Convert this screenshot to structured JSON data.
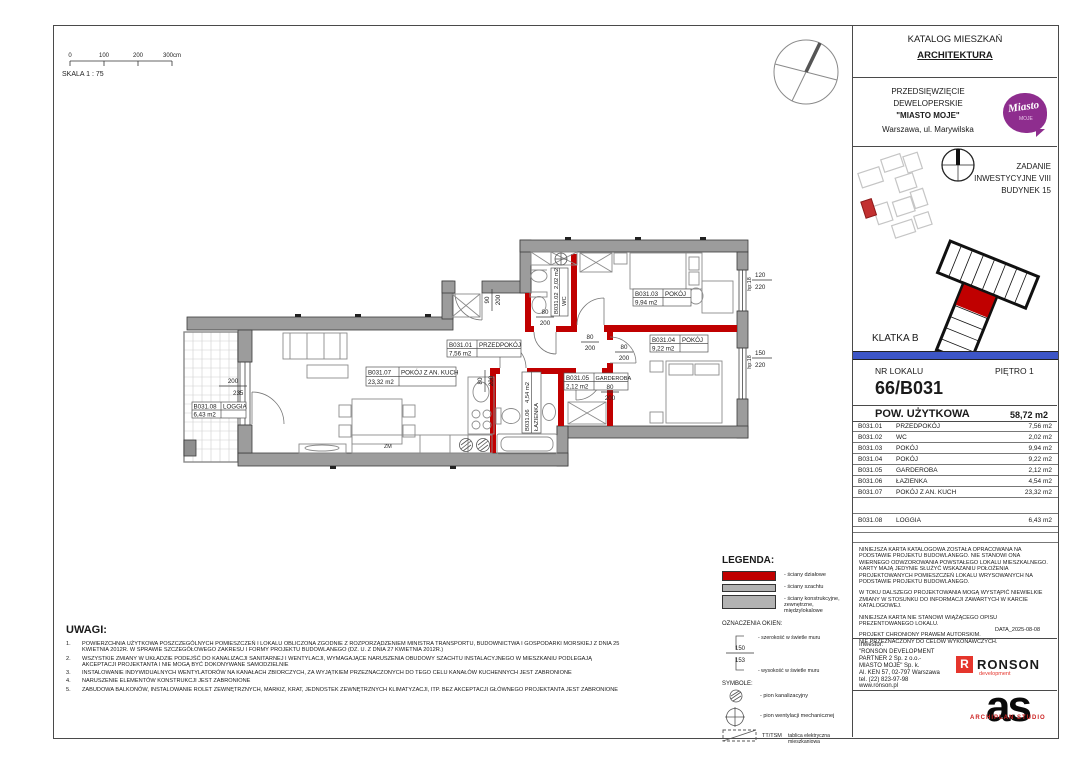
{
  "sheet": {
    "scale": {
      "t0": "0",
      "t1": "100",
      "t2": "200",
      "t3": "300cm",
      "label": "SKALA 1 : 75"
    }
  },
  "title_block": {
    "catalog_line1": "KATALOG MIESZKAŃ",
    "catalog_line2": "ARCHITEKTURA",
    "development": {
      "line1": "PRZEDSIĘWZIĘCIE",
      "line2": "DEWELOPERSKIE",
      "line3": "\"MIASTO MOJE\"",
      "line4": "Warszawa, ul. Marywilska"
    },
    "logo": {
      "line1": "Miasto",
      "line2": "MOJE",
      "color": "#8e2d8e"
    },
    "task": {
      "line1": "ZADANIE",
      "line2": "INWESTYCYJNE VIII",
      "line3": "BUDYNEK 15"
    },
    "staircase": "KLATKA  B",
    "unit": {
      "label": "NR LOKALU",
      "floor": "PIĘTRO 1",
      "number": "66/B031"
    },
    "area_header": {
      "label": "POW. UŻYTKOWA",
      "value": "58,72 m2"
    },
    "rooms": [
      {
        "id": "B031.01",
        "name": "PRZEDPOKÓJ",
        "area": "7,56 m2"
      },
      {
        "id": "B031.02",
        "name": "WC",
        "area": "2,02 m2"
      },
      {
        "id": "B031.03",
        "name": "POKÓJ",
        "area": "9,94 m2"
      },
      {
        "id": "B031.04",
        "name": "POKÓJ",
        "area": "9,22 m2"
      },
      {
        "id": "B031.05",
        "name": "GARDEROBA",
        "area": "2,12 m2"
      },
      {
        "id": "B031.06",
        "name": "ŁAZIENKA",
        "area": "4,54 m2"
      },
      {
        "id": "B031.07",
        "name": "POKÓJ Z AN. KUCH",
        "area": "23,32 m2"
      },
      {
        "id": "B031.08",
        "name": "LOGGIA",
        "area": "6,43 m2"
      }
    ],
    "disclaimer": {
      "p1": "NINIEJSZA KARTA KATALOGOWA ZOSTAŁA OPRACOWANA NA PODSTAWIE PROJEKTU BUDOWLANEGO. NIE STANOWI ONA WIERNEGO ODWZOROWANIA POWSTAŁEGO LOKALU MIESZKALNEGO. KARTY MAJĄ JEDYNIE SŁUŻYĆ WSKAZANIU POŁOŻENIA PROJEKTOWANYCH POMIESZCZEŃ LOKALU WRYSOWANYCH NA PODSTAWIE PROJEKTU BUDOWLANEGO.",
      "p2": "W TOKU DALSZEGO PROJEKTOWANIA MOGĄ WYSTĄPIĆ NIEWIELKIE ZMIANY W STOSUNKU DO INFORMACJI ZAWARTYCH W KARCIE KATALOGOWEJ.",
      "p3": "NINIEJSZA KARTA NIE STANOWI WIĄŻĄCEGO OPISU PREZENTOWANEGO LOKALU.",
      "c1": "PROJEKT CHRONIONY PRAWEM AUTORSKIM.",
      "c2": "NIE PRZEZNACZONY DO CELÓW WYKONAWCZYCH.",
      "date": "DATA_2025-08-08"
    },
    "investor": {
      "label": "Inwestor:",
      "l1": "\"RONSON DEVELOPMENT",
      "l2": "PARTNER 2 Sp. z o.o.-",
      "l3": "MIASTO MOJE\" Sp. k.",
      "l4": "Al. KEN 57, 02-797 Warszawa",
      "l5": "tel. (22) 823-97-98",
      "l6": "www.ronson.pl",
      "brand_letter": "R",
      "brand": "RONSON",
      "brand_sub": "development",
      "brand_red": "#e5352c"
    },
    "studio": {
      "mark": "as",
      "caption": "ARCHIPLAN STUDIO"
    }
  },
  "legend": {
    "title": "LEGENDA:",
    "item1": "- ściany działowe",
    "item2": "- ściany szachtu",
    "item3": "- ściany konstrukcyjne, zewnętrzne, międzylokalowe",
    "windows_title": "OZNACZENIA OKIEN:",
    "win_w": "150",
    "win_h": "153",
    "width_label": "- szerokość w świetle muru",
    "height_label": "- wysokość w świetle muru",
    "symbols_title": "SYMBOLE:",
    "sym1": "- pion kanalizacyjny",
    "sym2": "- pion wentylacji mechanicznej",
    "board_code": "TT/TSM",
    "board_label": "tablica elektryczna mieszkaniowa",
    "wall_red": "#c00000",
    "wall_gray": "#9c9c9c"
  },
  "notes": {
    "title": "UWAGI:",
    "items": [
      {
        "n": "1.",
        "text": "POWIERZCHNIA UŻYTKOWA POSZCZEGÓLNYCH POMIESZCZEŃ I LOKALU OBLICZONA ZGODNIE Z ROZPORZĄDZENIEM MINISTRA TRANSPORTU, BUDOWNICTWA I GOSPODARKI MORSKIEJ Z DNIA 25 KWIETNIA 2012R. W SPRAWIE SZCZEGÓŁOWEGO ZAKRESU I FORMY PROJEKTU BUDOWLANEGO (DZ. U. Z DNIA 27 KWIETNIA 2012R.)"
      },
      {
        "n": "2.",
        "text": "WSZYSTKIE ZMIANY W UKŁADZIE PODEJŚĆ DO KANALIZACJI SANITARNEJ I WENTYLACJI, WYMAGAJĄCE NARUSZENIA OBUDOWY SZACHTU INSTALACYJNEGO W MIESZKANIU PODLEGAJĄ AKCEPTACJI PROJEKTANTA I NIE MOGĄ BYĆ DOKONYWANE SAMODZIELNIE"
      },
      {
        "n": "3.",
        "text": "INSTALOWANIE INDYWIDUALNYCH WENTYLATORÓW NA KANAŁACH ZBIORCZYCH, ZA WYJĄTKIEM PRZEZNACZONYCH DO TEGO CELU KANAŁÓW KUCHENNYCH JEST ZABRONIONE"
      },
      {
        "n": "4.",
        "text": "NARUSZENIE ELEMENTÓW KONSTRUKCJI JEST ZABRONIONE"
      },
      {
        "n": "5.",
        "text": "ZABUDOWA BALKONÓW, INSTALOWANIE ROLET ZEWNĘTRZNYCH, MARKIZ, KRAT, JEDNOSTEK ZEWNĘTRZNYCH KLIMATYZACJI, ITP. BEZ AKCEPTACJI GŁÓWNEGO PROJEKTANTA JEST ZABRONIONE"
      }
    ]
  },
  "plan": {
    "dims": {
      "loggia": {
        "w": "200",
        "h": "235"
      },
      "entry": {
        "w": "90",
        "h": "200"
      },
      "door": {
        "w": "80",
        "h": "200"
      },
      "win1": {
        "w": "120",
        "h": "220"
      },
      "win2": {
        "w": "150",
        "h": "220"
      },
      "sill": "hp:18"
    },
    "misc": {
      "zm": "ZM"
    }
  }
}
